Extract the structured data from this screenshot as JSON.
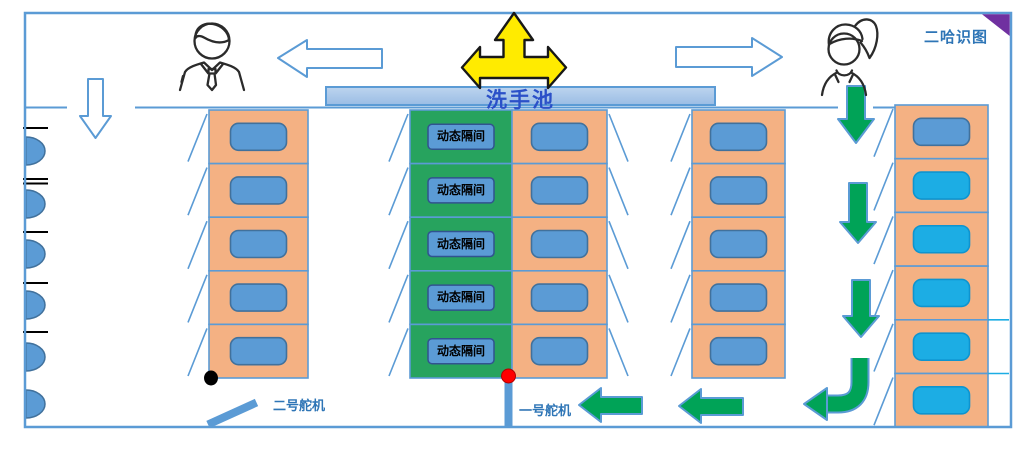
{
  "corner_tag": {
    "text": "二哈识图"
  },
  "sink": {
    "label": "洗手池"
  },
  "servos": {
    "servo1_label": "一号舵机",
    "servo2_label": "二号舵机"
  },
  "dynamic_stall": {
    "label": "动态隔间",
    "count": 5
  },
  "stall_columns": [
    {
      "id": "left-stall-column",
      "rows": 5,
      "door_side": "left",
      "cell_type": "toilet",
      "plates": [
        "blue",
        "blue",
        "blue",
        "blue",
        "blue"
      ]
    },
    {
      "id": "dynamic-stall-column",
      "rows": 5,
      "door_side": "left",
      "cell_type": "dynamic"
    },
    {
      "id": "center-stall-column",
      "rows": 5,
      "door_side": "right",
      "cell_type": "toilet",
      "plates": [
        "blue",
        "blue",
        "blue",
        "blue",
        "blue"
      ]
    },
    {
      "id": "right-stall-column",
      "rows": 5,
      "door_side": "left",
      "cell_type": "toilet",
      "plates": [
        "blue",
        "blue",
        "blue",
        "blue",
        "blue"
      ]
    },
    {
      "id": "wall-stall-column",
      "rows": 6,
      "door_side": "left",
      "cell_type": "toilet",
      "plates": [
        "blue",
        "cyan",
        "cyan",
        "cyan",
        "cyan",
        "cyan"
      ]
    }
  ],
  "urinals": {
    "count": 6,
    "tick_marks": 5
  },
  "colors": {
    "wall_blue": "#5B9BD5",
    "wall_blue_dark": "#41719C",
    "stall_orange": "#F4B183",
    "plate_blue": "#5B9BD5",
    "plate_border": "#41719C",
    "dynamic_green": "#27A35E",
    "vacant_cyan": "#1CADE4",
    "flow_green": "#00A357",
    "arrow_yellow": "#FFEB00",
    "label_blue": "#2E75B6",
    "sink_text_blue": "#2B50C8",
    "sink_fill": "#A9C6E9",
    "corner_purple": "#7030A0",
    "pivot_red": "#FF0000",
    "pivot_black": "#000000"
  }
}
